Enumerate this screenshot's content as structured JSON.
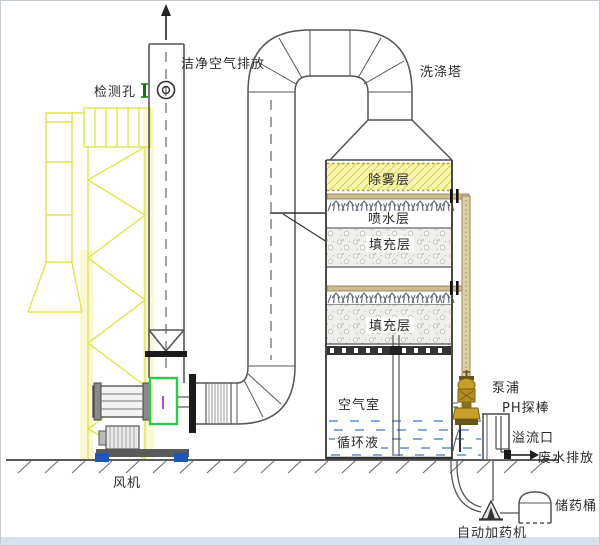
{
  "diagram": {
    "labels": {
      "clean_air_outlet": "洁净空气排放",
      "inspection_hole": "检测孔",
      "scrubber_tower": "洗涤塔",
      "demister_layer": "除雾层",
      "spray_layer": "喷水层",
      "packing_layer_upper": "填充层",
      "packing_layer_lower": "填充层",
      "air_chamber": "空气室",
      "circulating_liquid": "循环液",
      "pump": "泵浦",
      "ph_probe": "PH探棒",
      "overflow_port": "溢流口",
      "waste_water_discharge": "废水排放",
      "chemical_drum": "储药桶",
      "auto_dosing_machine": "自动加药机",
      "fan": "风机"
    },
    "colors": {
      "truss_yellow": "#e3e34f",
      "truss_pale_band": "#f8f8d2",
      "demister_yellow": "#f6f4ad",
      "green_flex": "#2fc94f",
      "pipe_tan": "#cdbc8d",
      "pump_gold": "#c79f2a",
      "water_blue": "#5b8fd0",
      "anchor_blue": "#1d57b5",
      "grating_dark": "#333333",
      "bottom_strip": "#d7e1ef"
    }
  }
}
